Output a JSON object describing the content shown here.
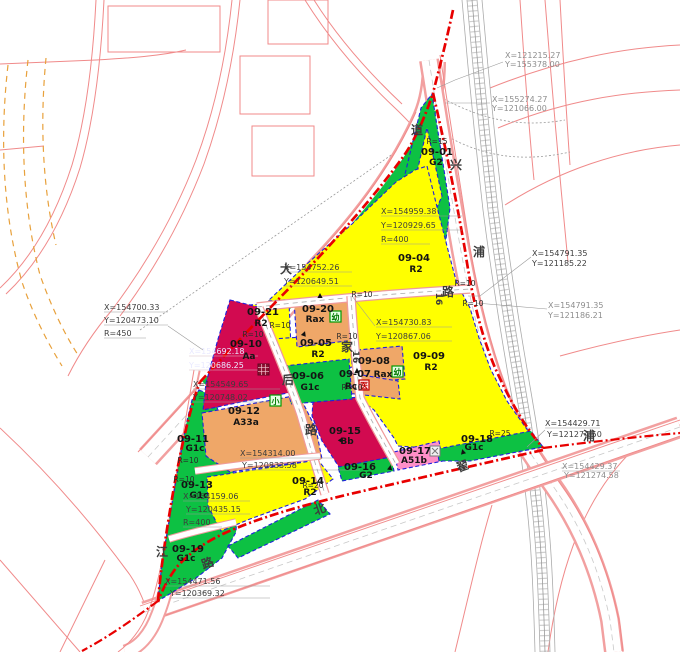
{
  "map": {
    "type": "urban-planning-parcel-map",
    "colors": {
      "residential_R2_yellow": "#FFFF00",
      "green_space_G": "#0DC143",
      "civic_Aa_Bb_crimson": "#D20A50",
      "school_A33a_Rax_tan": "#EFA768",
      "commercial_A51b_pink": "#FF8FC8",
      "road_line_pink": "#F08080",
      "site_boundary_red": "#E80000",
      "parcel_edge_blue": "#2020DD",
      "railway_gray": "#ABABAB",
      "reserve_dash_orange": "#E8A13C"
    },
    "parcels": [
      {
        "code": "09-01",
        "use": "G2"
      },
      {
        "code": "09-04",
        "use": "R2"
      },
      {
        "code": "09-05",
        "use": "R2"
      },
      {
        "code": "09-06",
        "use": "G1c"
      },
      {
        "code": "09-07",
        "use": "Rc"
      },
      {
        "code": "09-08",
        "use": "Rax"
      },
      {
        "code": "09-09",
        "use": "R2"
      },
      {
        "code": "09-10",
        "use": "Aa"
      },
      {
        "code": "09-11",
        "use": "G1c"
      },
      {
        "code": "09-12",
        "use": "A33a"
      },
      {
        "code": "09-13",
        "use": "G1c"
      },
      {
        "code": "09-14",
        "use": "R2"
      },
      {
        "code": "09-15",
        "use": "Bb"
      },
      {
        "code": "09-16",
        "use": "G2"
      },
      {
        "code": "09-17",
        "use": "A51b"
      },
      {
        "code": "09-18",
        "use": "G1c"
      },
      {
        "code": "09-19",
        "use": "G1c"
      },
      {
        "code": "09-20",
        "use": "Rax"
      },
      {
        "code": "09-21",
        "use": "R2"
      }
    ],
    "coordinates": [
      {
        "x": "X=121215.27",
        "y": "Y=155378.00"
      },
      {
        "x": "X=155274.27",
        "y": "Y=121066.00"
      },
      {
        "x": "X=154959.38",
        "y": "Y=120929.65",
        "r": "R=400"
      },
      {
        "x": "X=154791.35",
        "y": "Y=121185.22"
      },
      {
        "x": "X=154791.35",
        "y": "Y=121186.21"
      },
      {
        "x": "X=154752.26",
        "y": "Y=120649.51"
      },
      {
        "x": "X=154700.33",
        "y": "Y=120473.10",
        "r": "R=450"
      },
      {
        "x": "X=154730.83",
        "y": "Y=120867.06"
      },
      {
        "x": "X=154692.18",
        "y": "Y=120686.25"
      },
      {
        "x": "X=154549.65",
        "y": "Y=120748.02"
      },
      {
        "x": "X=154314.00",
        "y": "Y=120833.58"
      },
      {
        "x": "X=154159.06",
        "y": "Y=120435.15",
        "r": "R=400"
      },
      {
        "x": "X=154429.71",
        "y": "Y=121274.50"
      },
      {
        "x": "X=154429.37",
        "y": "Y=121274.58"
      },
      {
        "x": "X=154471.56",
        "y": "Y=120369.32"
      }
    ],
    "radius_labels": [
      "R=15",
      "R=10",
      "R=10",
      "R=10",
      "R=10",
      "R=10",
      "R=10",
      "R=10",
      "R=10",
      "R=20",
      "R=25",
      "R=10"
    ],
    "road_chars": [
      "道",
      "兴",
      "浦",
      "大",
      "家",
      "后",
      "路",
      "路",
      "16",
      "16",
      "北",
      "翟",
      "路",
      "江",
      "浦"
    ],
    "icons": {
      "kindergarten": "幼",
      "primary_school": "小",
      "clinic": "医"
    }
  }
}
